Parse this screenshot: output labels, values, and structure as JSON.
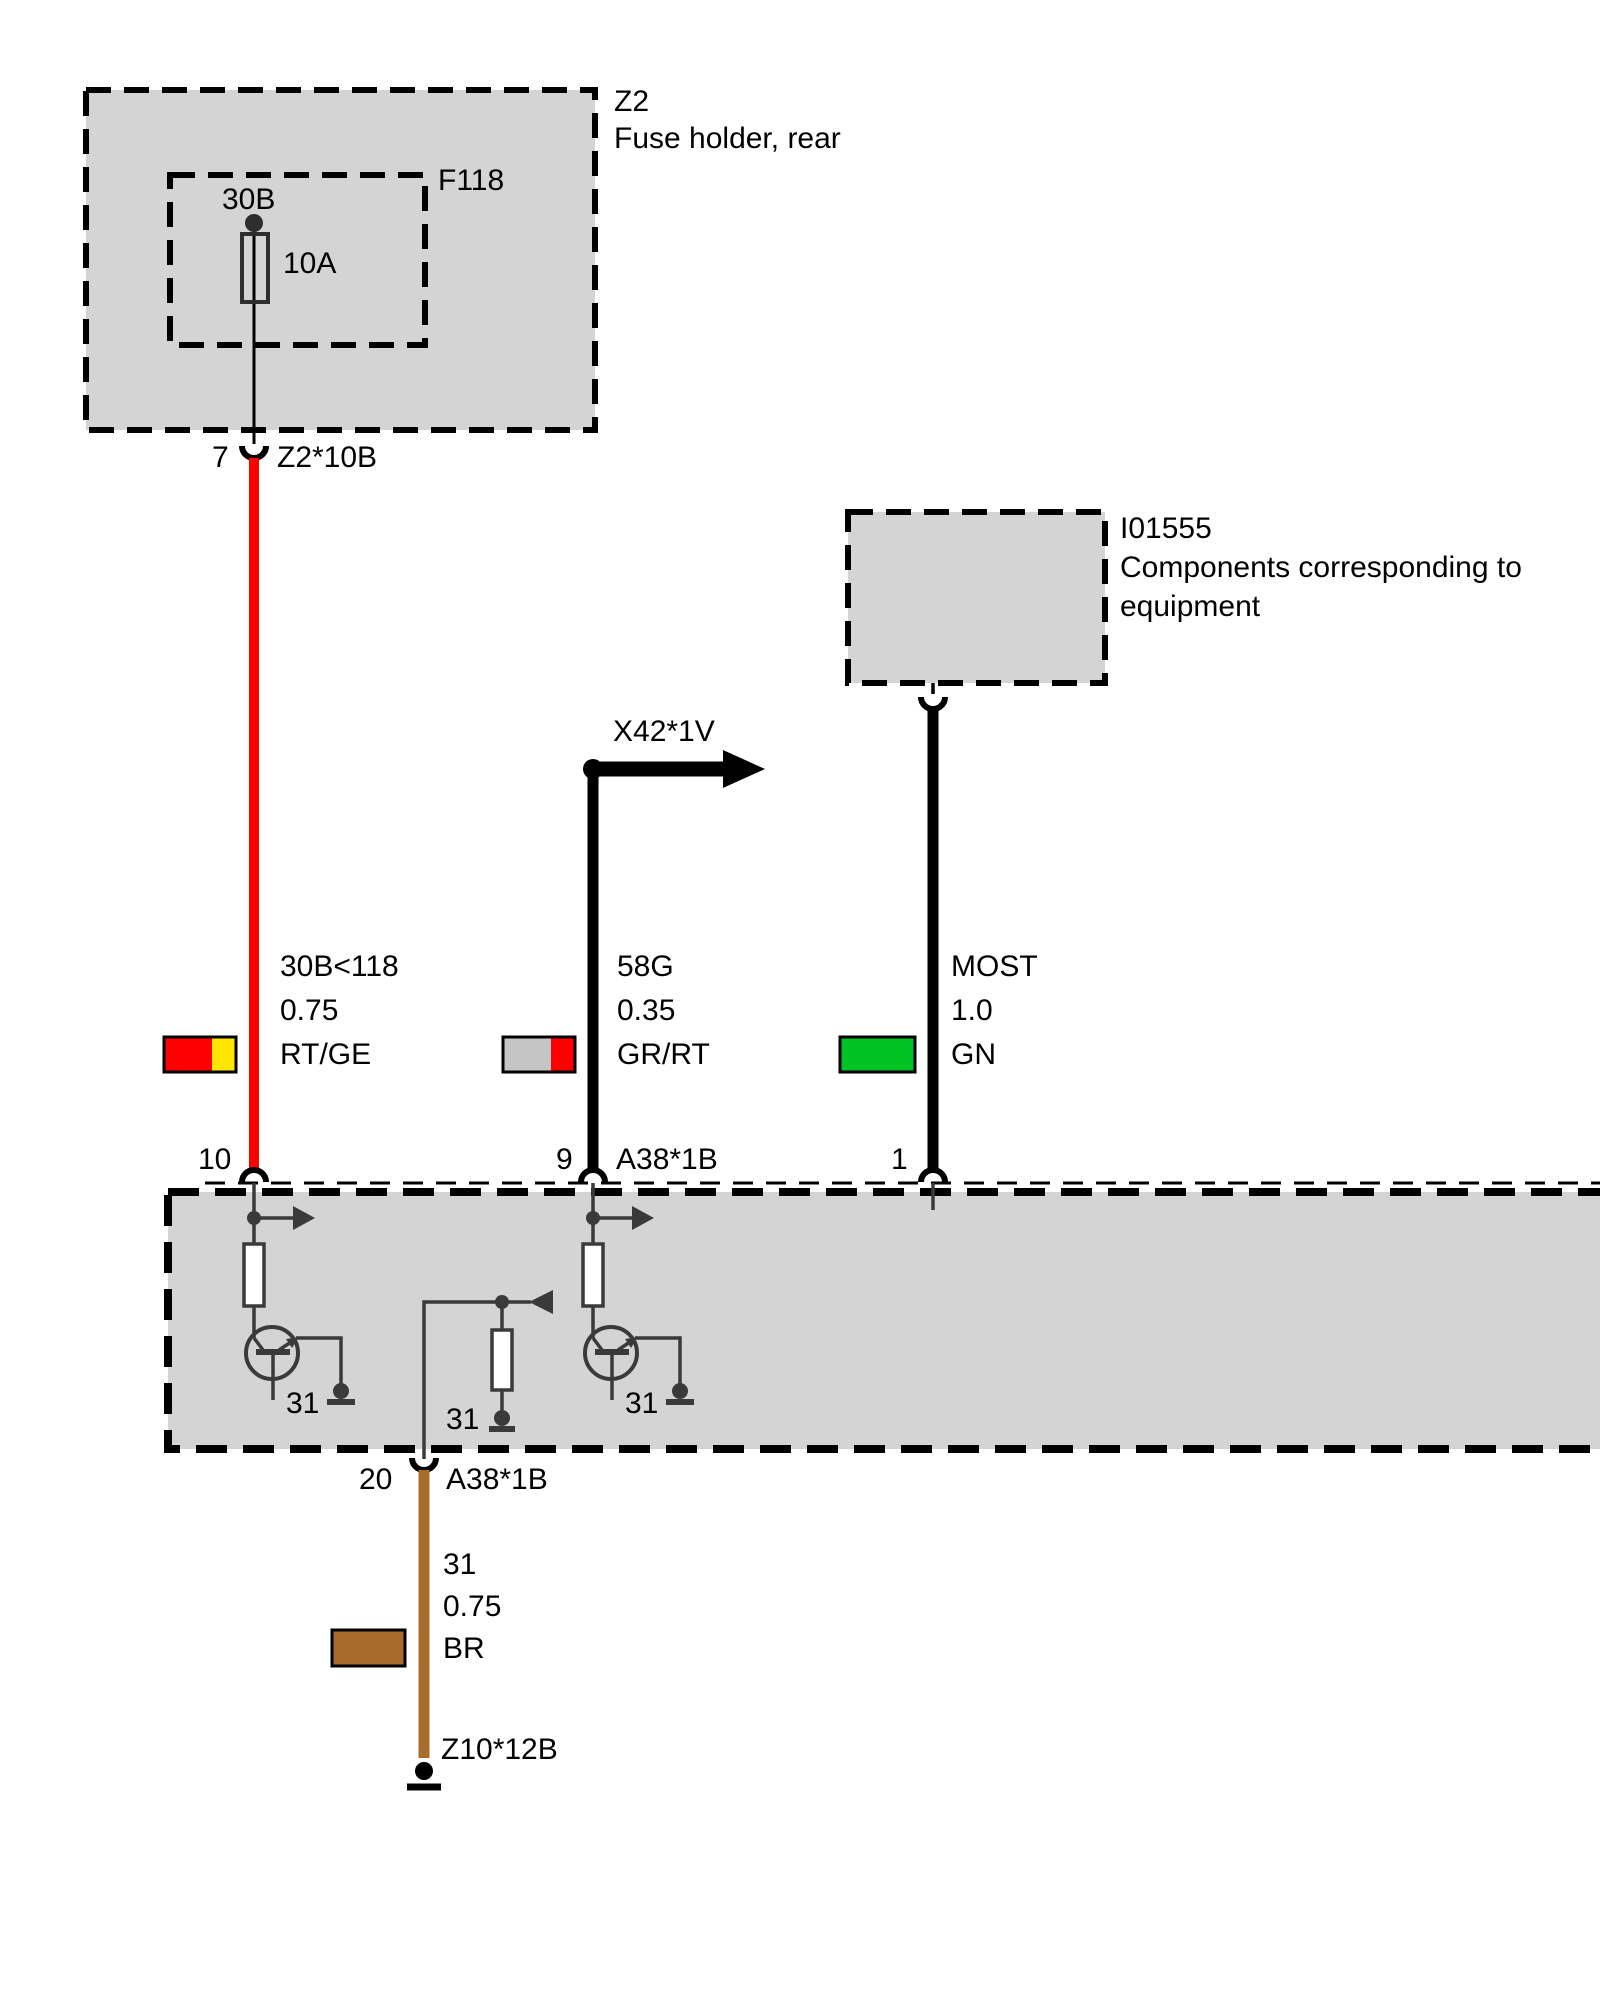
{
  "colors": {
    "red": "#FF0000",
    "yellow": "#FFE600",
    "green": "#00C323",
    "gray_swatch": "#C5C5C5",
    "brown": "#A76B2C",
    "box_fill": "#D4D4D4",
    "wire_black": "#000000"
  },
  "z2": {
    "id": "Z2",
    "name": "Fuse holder, rear",
    "fuse_id": "F118",
    "terminal": "30B",
    "rating": "10A",
    "pin": "7",
    "connector": "Z2*10B"
  },
  "i01555": {
    "id": "I01555",
    "desc_line1": "Components corresponding to",
    "desc_line2": "equipment"
  },
  "branch": {
    "label": "X42*1V"
  },
  "wires": {
    "w1": {
      "circuit": "30B<118",
      "cross_section": "0.75",
      "color_code": "RT/GE"
    },
    "w2": {
      "circuit": "58G",
      "cross_section": "0.35",
      "color_code": "GR/RT"
    },
    "w3": {
      "circuit": "MOST",
      "cross_section": "1.0",
      "color_code": "GN"
    },
    "w4": {
      "circuit": "31",
      "cross_section": "0.75",
      "color_code": "BR"
    }
  },
  "module": {
    "pin10": "10",
    "pin9": "9",
    "pin1": "1",
    "pin20": "20",
    "connector_top": "A38*1B",
    "connector_bottom": "A38*1B",
    "gnd1": "31",
    "gnd2": "31",
    "gnd3": "31"
  },
  "ground": {
    "connector": "Z10*12B"
  }
}
